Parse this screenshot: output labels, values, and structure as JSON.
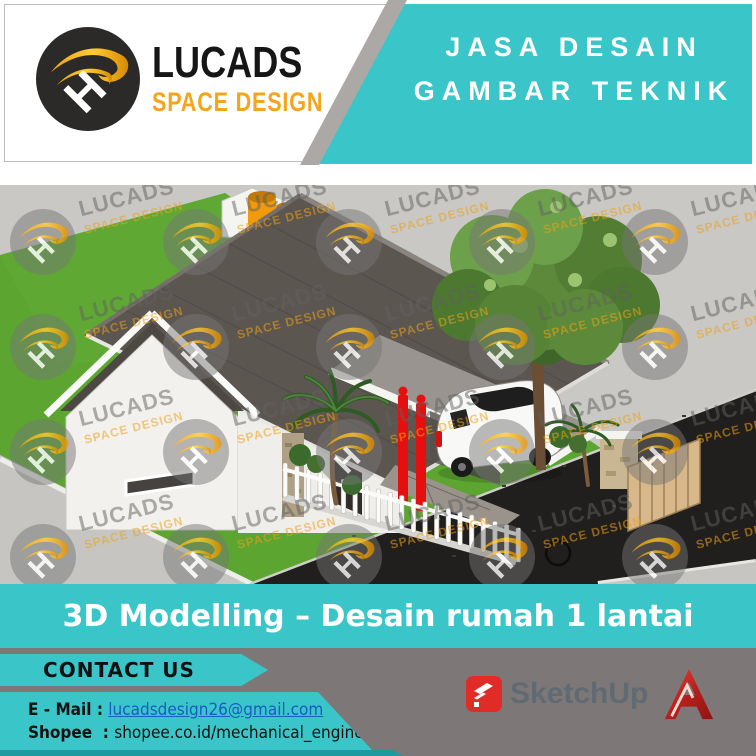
{
  "brand": {
    "name": "LUCADS",
    "subtitle": "SPACE DESIGN",
    "monogram": "H"
  },
  "banner": {
    "line1": "JASA DESAIN",
    "line2": "GAMBAR TEKNIK"
  },
  "caption": "3D Modelling – Desain rumah 1 lantai",
  "contact": {
    "heading": "CONTACT US",
    "email_label": "E - Mail : ",
    "email": "lucadsdesign26@gmail.com",
    "shopee_label": "Shopee  : ",
    "shopee_value": "shopee.co.id/mechanical_engineering"
  },
  "software": {
    "sketchup_label": "SketchUp"
  },
  "watermark": {
    "text_primary": "LUCADS",
    "text_secondary": "SPACE DESIGN",
    "monogram": "H",
    "cols": [
      43,
      196,
      349,
      502,
      655
    ],
    "rows": [
      242,
      347,
      452,
      557
    ],
    "scene_top": 185
  },
  "colors": {
    "teal": "#3AC6C9",
    "tealDark": "#1D9AA0",
    "footerGray": "#7D7877",
    "stripeGray": "#ACA8A6",
    "orange": "#F5A41E",
    "linkBlue": "#1A5BC4",
    "accentRed": "#E60F0F",
    "sketchupRed": "#E12B26",
    "autocadRed": "#B71F1C",
    "skText": "#5F6A73",
    "lawnGreen": "#5CA531",
    "roofGray": "#5C5651",
    "asphalt": "#211F1D"
  }
}
